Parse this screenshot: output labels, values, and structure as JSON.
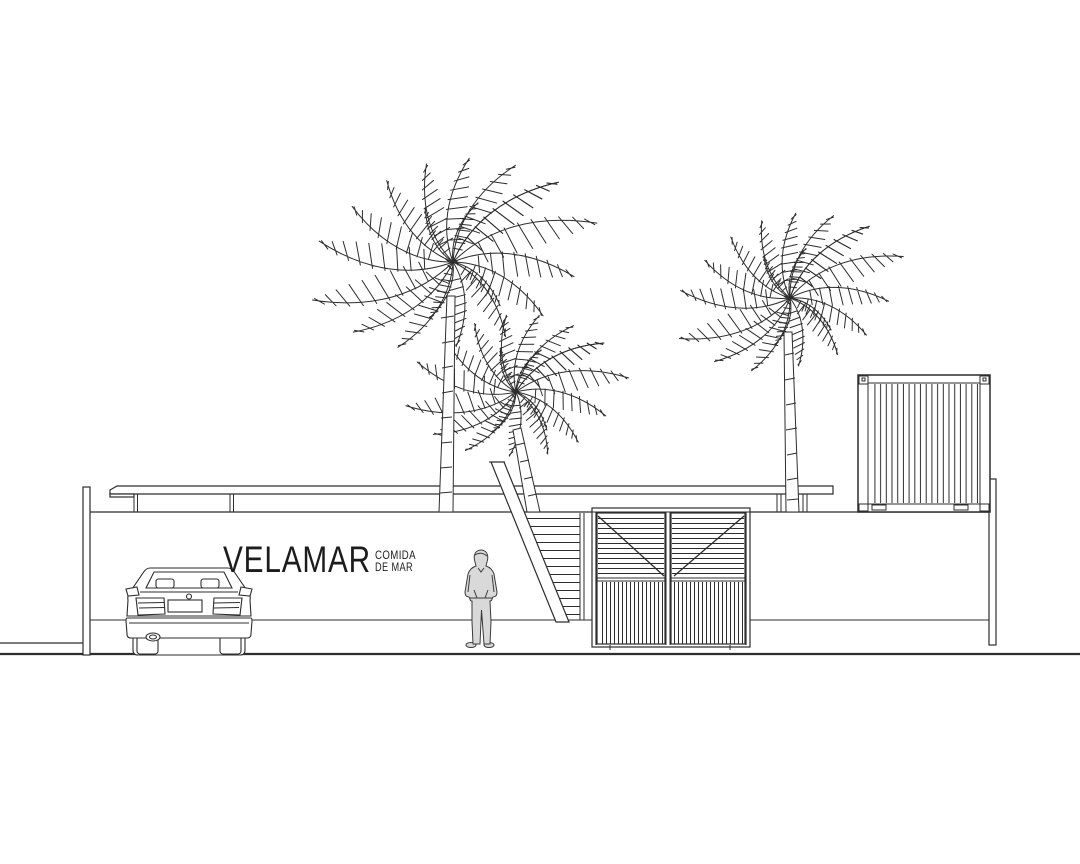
{
  "page": {
    "type": "architectural-elevation-drawing",
    "background": "#ffffff",
    "width": 1080,
    "height": 864
  },
  "palette": {
    "line": "#2d2d2d",
    "text": "#1c1c1c",
    "person_fill": "#d9d9d9"
  },
  "signage": {
    "brand": "VELAMAR",
    "tagline_line1": "COMIDA",
    "tagline_line2": "DE MAR"
  },
  "scene": {
    "objects": [
      "palm-tree-tall",
      "palm-tree-small",
      "palm-tree-right",
      "flat-roof-canopy",
      "boundary-wall",
      "left-end-post",
      "right-end-post",
      "exterior-staircase",
      "louvered-double-gate",
      "shipping-container",
      "sedan-rear-view",
      "standing-person",
      "ground-line",
      "sidewalk-line"
    ]
  }
}
